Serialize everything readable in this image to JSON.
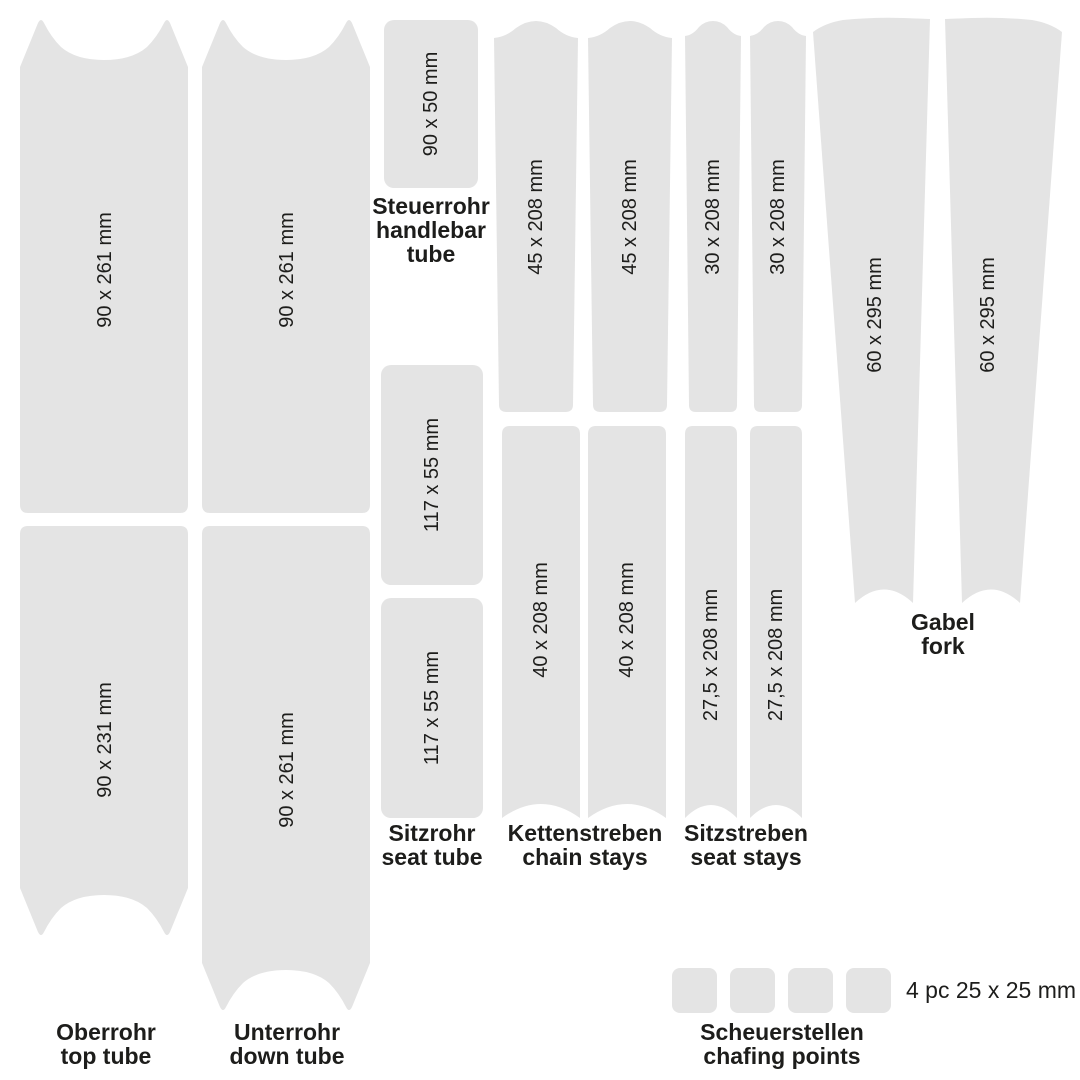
{
  "colors": {
    "piece_fill": "#e4e4e4",
    "text": "#1d1d1b",
    "background": "#ffffff"
  },
  "kit": {
    "top_tube": {
      "name_de": "Oberrohr",
      "name_en": "top tube",
      "upper_piece": "90 x 261 mm",
      "lower_piece": "90 x 231 mm"
    },
    "down_tube": {
      "name_de": "Unterrohr",
      "name_en": "down tube",
      "upper_piece": "90 x 261 mm",
      "lower_piece": "90 x 261 mm"
    },
    "handlebar_tube": {
      "name_de": "Steuerrohr",
      "name_en": "handlebar tube",
      "piece": "90 x 50 mm"
    },
    "seat_tube": {
      "name_de": "Sitzrohr",
      "name_en": "seat tube",
      "piece_1": "117 x 55 mm",
      "piece_2": "117 x 55 mm"
    },
    "chain_stays": {
      "name_de": "Kettenstreben",
      "name_en": "chain stays",
      "upper_piece_1": "45 x 208 mm",
      "upper_piece_2": "45 x 208 mm",
      "lower_piece_1": "40 x 208 mm",
      "lower_piece_2": "40 x 208 mm"
    },
    "seat_stays": {
      "name_de": "Sitzstreben",
      "name_en": "seat stays",
      "upper_piece_1": "30 x 208 mm",
      "upper_piece_2": "30 x 208 mm",
      "lower_piece_1": "27,5 x 208 mm",
      "lower_piece_2": "27,5 x 208 mm"
    },
    "fork": {
      "name_de": "Gabel",
      "name_en": "fork",
      "piece_1": "60 x 295 mm",
      "piece_2": "60 x 295 mm"
    },
    "chafing_points": {
      "name_de": "Scheuerstellen",
      "name_en": "chafing points",
      "count": 4,
      "note": "4 pc 25 x 25 mm"
    }
  }
}
